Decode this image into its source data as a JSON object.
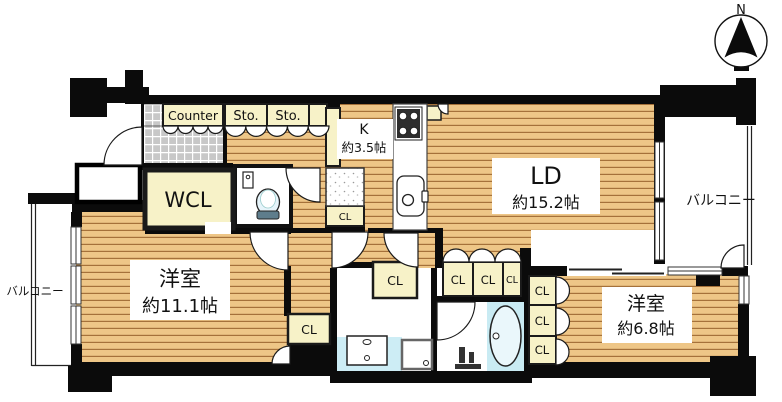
{
  "floorplan": {
    "compass": {
      "north_label": "N"
    },
    "rooms": {
      "living_dining": {
        "name": "LD",
        "size": "約15.2帖"
      },
      "kitchen": {
        "name": "K",
        "size": "約3.5帖"
      },
      "bedroom_main": {
        "name": "洋室",
        "size": "約11.1帖"
      },
      "bedroom_second": {
        "name": "洋室",
        "size": "約6.8帖"
      },
      "walk_in_closet": {
        "label": "WCL"
      },
      "balcony_left": {
        "label": "バルコニー"
      },
      "balcony_right": {
        "label": "バルコニー"
      }
    },
    "storage": {
      "counter": {
        "label": "Counter"
      },
      "storage_1": {
        "label": "Sto."
      },
      "storage_2": {
        "label": "Sto."
      },
      "closet_kitchen": {
        "label": "CL"
      },
      "closet_corridor": {
        "label": "CL"
      },
      "closet_washroom": {
        "label": "CL"
      },
      "closet_row_1": {
        "label": "CL"
      },
      "closet_row_2": {
        "label": "CL"
      },
      "closet_row_3": {
        "label": "CL"
      },
      "closet_stack_1": {
        "label": "CL"
      },
      "closet_stack_2": {
        "label": "CL"
      },
      "closet_stack_3": {
        "label": "CL"
      }
    },
    "colors": {
      "wood_floor": "#EEC687",
      "wood_line": "#A5713A",
      "closet_fill": "#F7F2C8",
      "tile_fill": "#C8C8C8",
      "water_blue": "#CDEDF5",
      "wall": "#0B0B0B"
    }
  }
}
